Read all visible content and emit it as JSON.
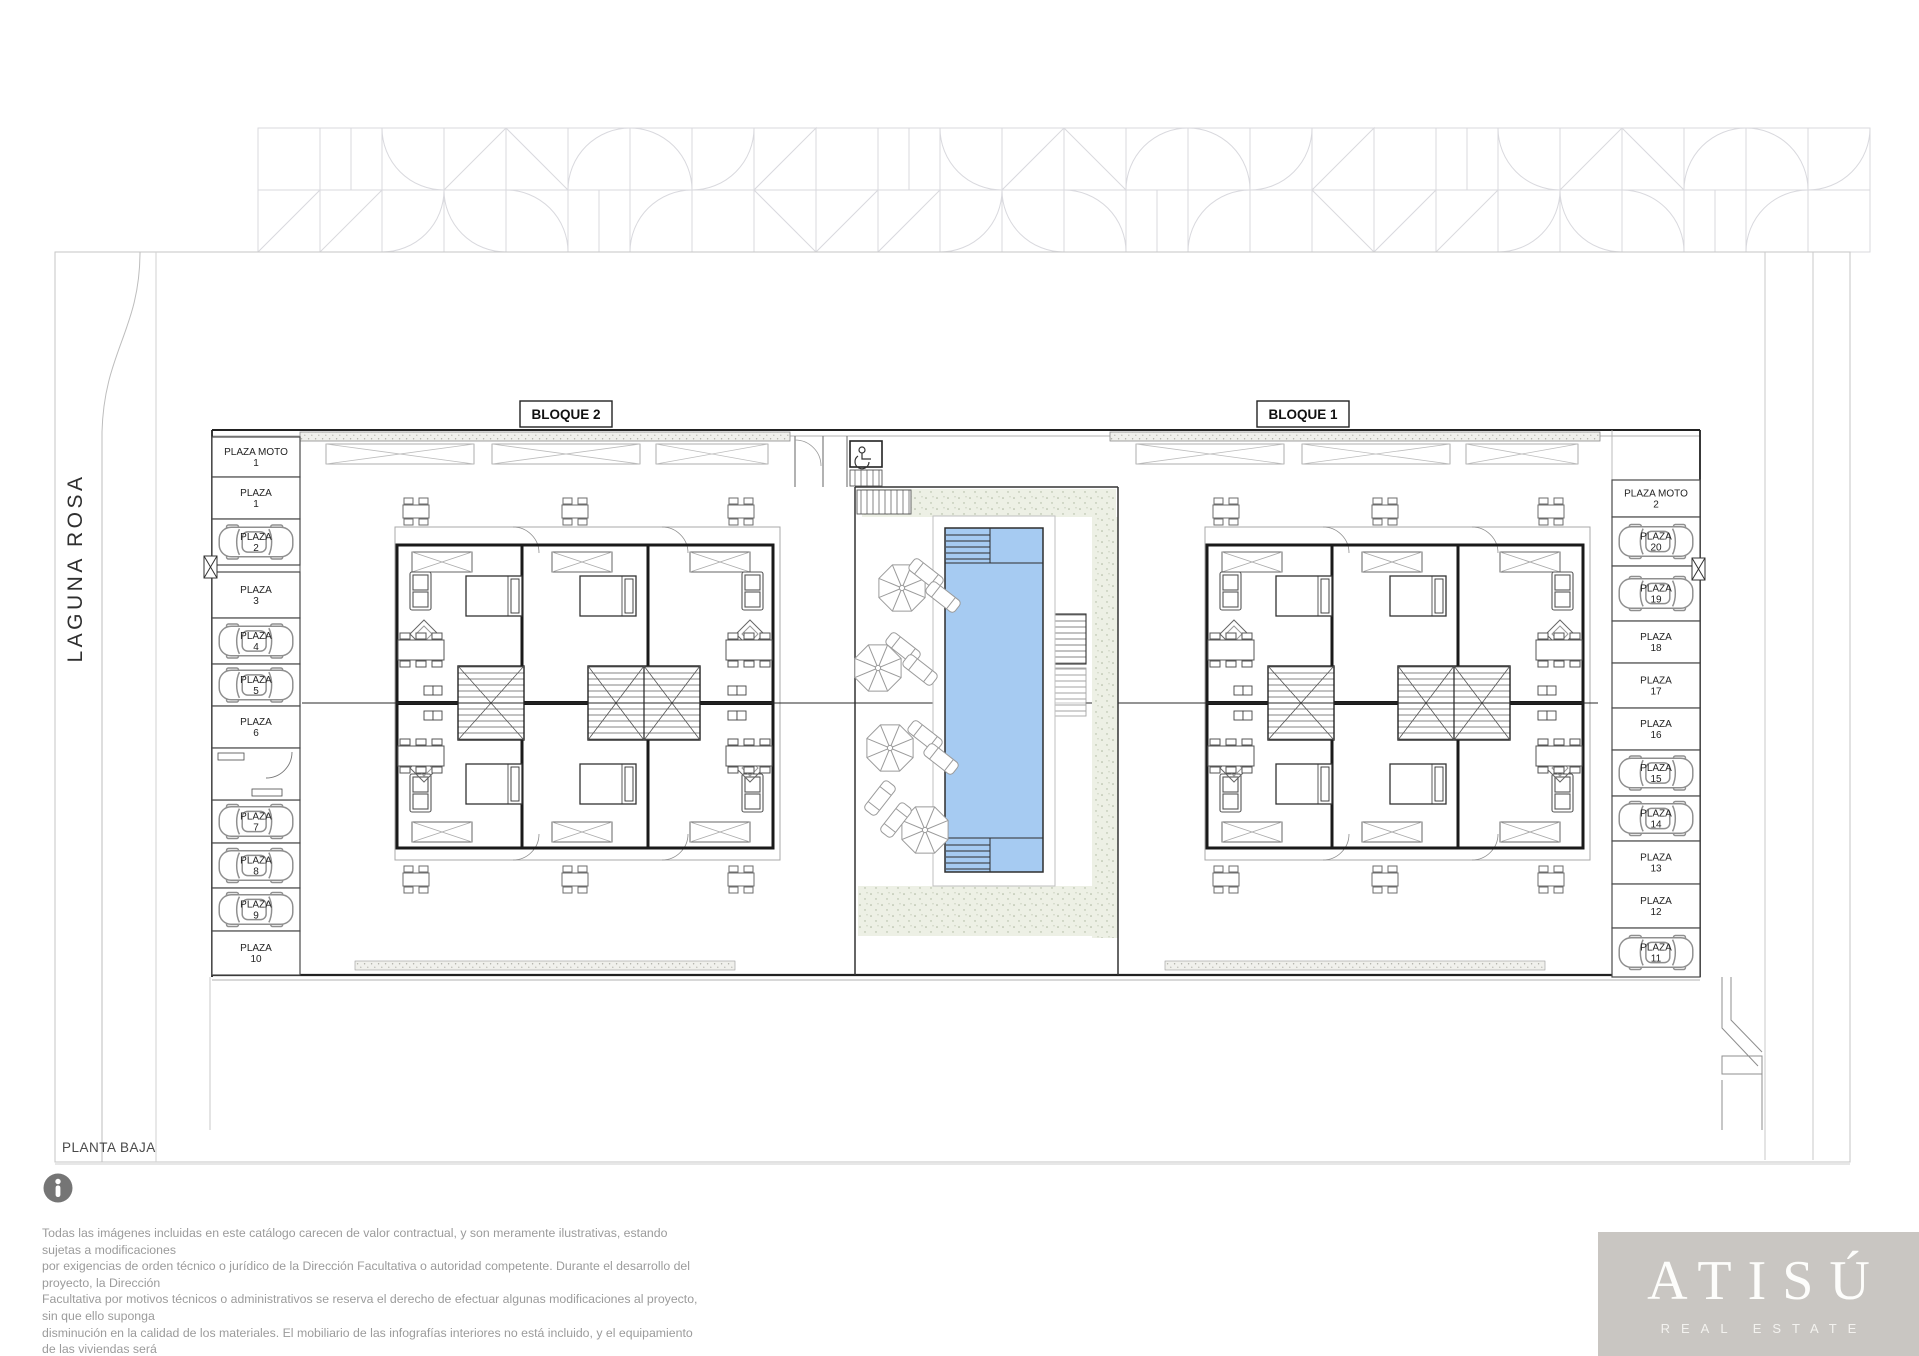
{
  "plan": {
    "title": "PLANTA BAJA",
    "street_label": "LAGUNA ROSA",
    "blocks": [
      {
        "label": "BLOQUE 2"
      },
      {
        "label": "BLOQUE 1"
      }
    ]
  },
  "parking": {
    "left": [
      {
        "line1": "PLAZA MOTO",
        "line2": "1",
        "car": false
      },
      {
        "line1": "PLAZA",
        "line2": "1",
        "car": false
      },
      {
        "line1": "PLAZA",
        "line2": "2",
        "car": true
      },
      {
        "line1": "PLAZA",
        "line2": "3",
        "car": false
      },
      {
        "line1": "PLAZA",
        "line2": "4",
        "car": true
      },
      {
        "line1": "PLAZA",
        "line2": "5",
        "car": true
      },
      {
        "line1": "PLAZA",
        "line2": "6",
        "car": false
      },
      {
        "line1": "PLAZA",
        "line2": "7",
        "car": true
      },
      {
        "line1": "PLAZA",
        "line2": "8",
        "car": true
      },
      {
        "line1": "PLAZA",
        "line2": "9",
        "car": true
      },
      {
        "line1": "PLAZA",
        "line2": "10",
        "car": false
      }
    ],
    "right": [
      {
        "line1": "PLAZA MOTO",
        "line2": "2",
        "car": false
      },
      {
        "line1": "PLAZA",
        "line2": "20",
        "car": true
      },
      {
        "line1": "PLAZA",
        "line2": "19",
        "car": true
      },
      {
        "line1": "PLAZA",
        "line2": "18",
        "car": false
      },
      {
        "line1": "PLAZA",
        "line2": "17",
        "car": false
      },
      {
        "line1": "PLAZA",
        "line2": "16",
        "car": false
      },
      {
        "line1": "PLAZA",
        "line2": "15",
        "car": true
      },
      {
        "line1": "PLAZA",
        "line2": "14",
        "car": true
      },
      {
        "line1": "PLAZA",
        "line2": "13",
        "car": false
      },
      {
        "line1": "PLAZA",
        "line2": "12",
        "car": false
      },
      {
        "line1": "PLAZA",
        "line2": "11",
        "car": true
      }
    ]
  },
  "disclaimer": {
    "lines": [
      "Todas las imágenes incluidas en este catálogo carecen de valor contractual, y son meramente ilustrativas, estando sujetas a modificaciones",
      "por exigencias de  orden técnico o jurídico de la Dirección Facultativa o autoridad competente. Durante el desarrollo del proyecto, la Dirección",
      "Facultativa por motivos técnicos o administrativos se reserva el derecho de efectuar algunas modificaciones al proyecto, sin que ello suponga",
      "disminución  en la calidad de los materiales. El mobiliario de las infografías interiores no está incluido, y el equipamiento de las viviendas será",
      "el indicado en la correspondiente memoria de calidades."
    ]
  },
  "logo": {
    "name": "ATISÚ",
    "tagline": "REAL ESTATE"
  },
  "colors": {
    "pool": "#a6cbf2",
    "stipple_bg": "#edf0e5",
    "logo_bg": "#c9c6c2",
    "pattern_line": "#d9d9de",
    "wall": "#1a1a1a"
  }
}
